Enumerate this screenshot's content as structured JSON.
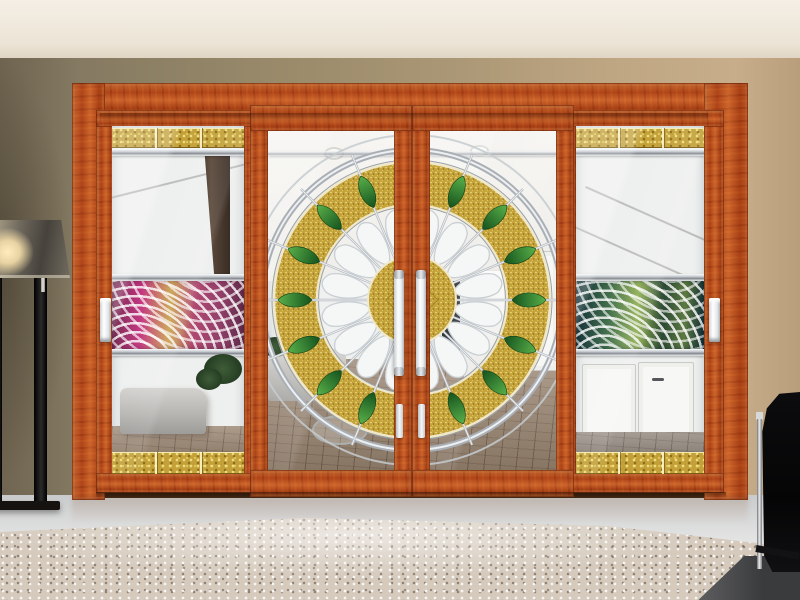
{
  "scene": {
    "description": "Interior photo of a four-panel wood-framed sliding glass door. The two centre sliding panels share a large circular stained-glass medallion with a textured gold ring, white fan petals and green leaves. The two outer panels have textured gold bands top and bottom and a wavy art-glass band across the middle (magenta-gold on the left, green-navy on the right). A black floor lamp stands at the left, a beige speckled rug and a black chrome-legged chair sit in the foreground.",
    "setting": "living room, tan walls, cream ceiling, glossy grey floor"
  },
  "objects": {
    "ceiling": "cream ceiling",
    "wall": "tan / olive wall",
    "floor": "glossy grey floor",
    "carpet": "beige speckled rug",
    "lamp": "black floor lamp with lit fabric shade",
    "chair": "black chair with chrome leg",
    "door_frame": "orange-red wood door casing",
    "door_left_outer": "left outer sliding panel with gold bands and magenta wave glass",
    "door_center_left": "centre-left sliding panel with medallion left half",
    "door_center_right": "centre-right sliding panel with medallion right half",
    "door_right_outer": "right outer sliding panel with gold bands and green wave glass",
    "medallion": "circular gold and chrome stained-glass medallion with green leaves",
    "handle_left": "white recessed handle, left outer panel",
    "handle_center_left": "white bar handle, centre-left panel",
    "handle_center_right": "white bar handle, centre-right panel",
    "handle_right": "white recessed handle, right outer panel"
  },
  "palette": {
    "wood": "#b84e1e",
    "wood_dark": "#7a2a0c",
    "gold": "#c3a138",
    "gold_light": "#eedc84",
    "leaf_green": "#2e7d32",
    "chrome": "#b9bfc5",
    "wall_left": "#857a62",
    "wall_right": "#c7ad89",
    "ceiling": "#f0ebe1",
    "floor": "#dcdddd",
    "carpet": "#d5cabc",
    "wave_left_main": "#c2327e",
    "wave_right_main": "#3c6b46",
    "lamp_black": "#141414",
    "handle_white": "#f2f4f5"
  }
}
